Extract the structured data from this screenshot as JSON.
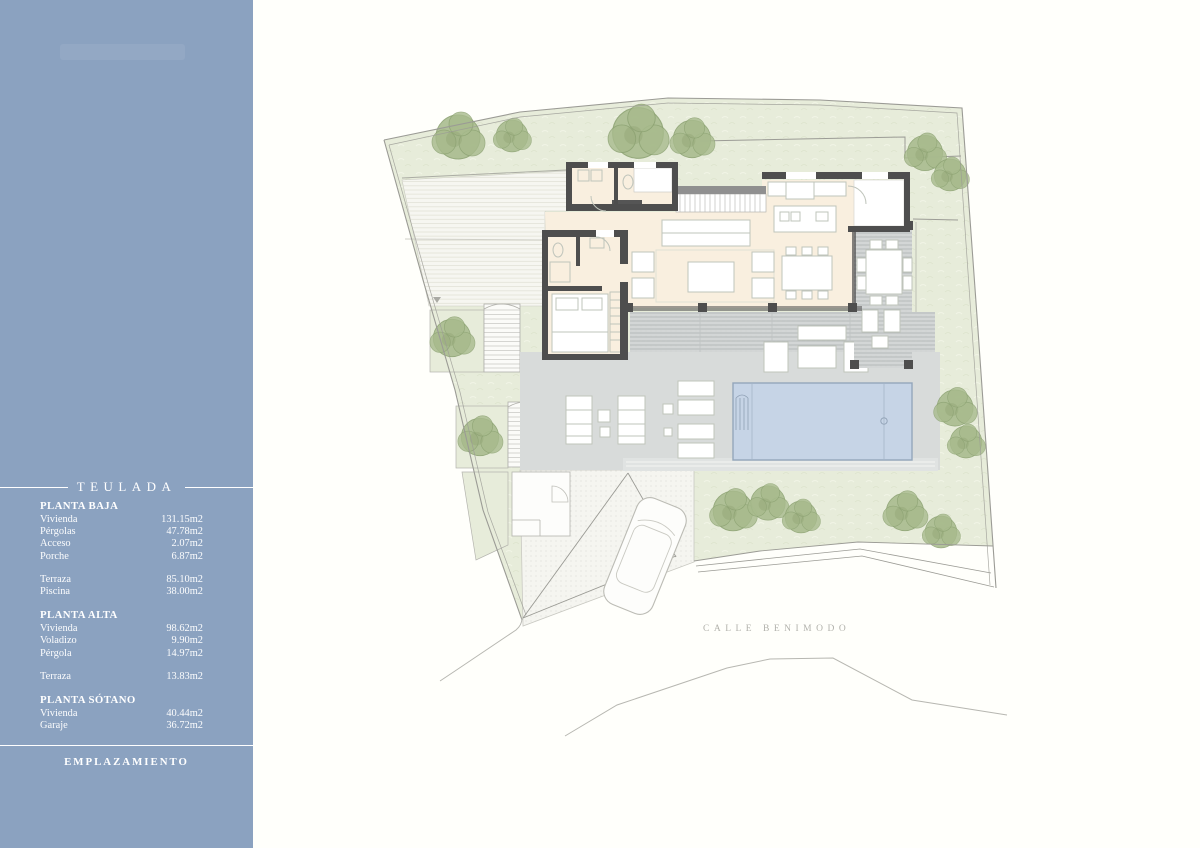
{
  "theme": {
    "sidebar_bg": "#8ba2c0",
    "paper": "#fffffb",
    "garden": "#e7ecda",
    "tree": "#a8bb8d",
    "tree_edge": "#8ba171",
    "wall": "#4e4e4e",
    "floor": "#f9efdf",
    "terrace": "#d8dbda",
    "pergola": "#d3d6d6",
    "pool": "#c6d4e6",
    "pool_edge": "#94a6bb",
    "deck": "#f6f6f1",
    "line": "#9c9c96",
    "furniture": "#bfc4bb",
    "street_text": "#b2b2ac"
  },
  "sidebar": {
    "project_title": "TEULADA",
    "footer_label": "EMPLAZAMIENTO",
    "sections": [
      {
        "title": "PLANTA BAJA",
        "groups": [
          [
            {
              "label": "Vivienda",
              "value": "131.15m2"
            },
            {
              "label": "Pérgolas",
              "value": "47.78m2"
            },
            {
              "label": "Acceso",
              "value": "2.07m2"
            },
            {
              "label": "Porche",
              "value": "6.87m2"
            }
          ],
          [
            {
              "label": "Terraza",
              "value": "85.10m2"
            },
            {
              "label": "Piscina",
              "value": "38.00m2"
            }
          ]
        ]
      },
      {
        "title": "PLANTA ALTA",
        "groups": [
          [
            {
              "label": "Vivienda",
              "value": "98.62m2"
            },
            {
              "label": "Voladizo",
              "value": "9.90m2"
            },
            {
              "label": "Pérgola",
              "value": "14.97m2"
            }
          ],
          [
            {
              "label": "Terraza",
              "value": "13.83m2"
            }
          ]
        ]
      },
      {
        "title": "PLANTA SÓTANO",
        "groups": [
          [
            {
              "label": "Vivienda",
              "value": "40.44m2"
            },
            {
              "label": "Garaje",
              "value": "36.72m2"
            }
          ]
        ]
      }
    ]
  },
  "plan": {
    "street_label": "CALLE BENIMODO"
  }
}
